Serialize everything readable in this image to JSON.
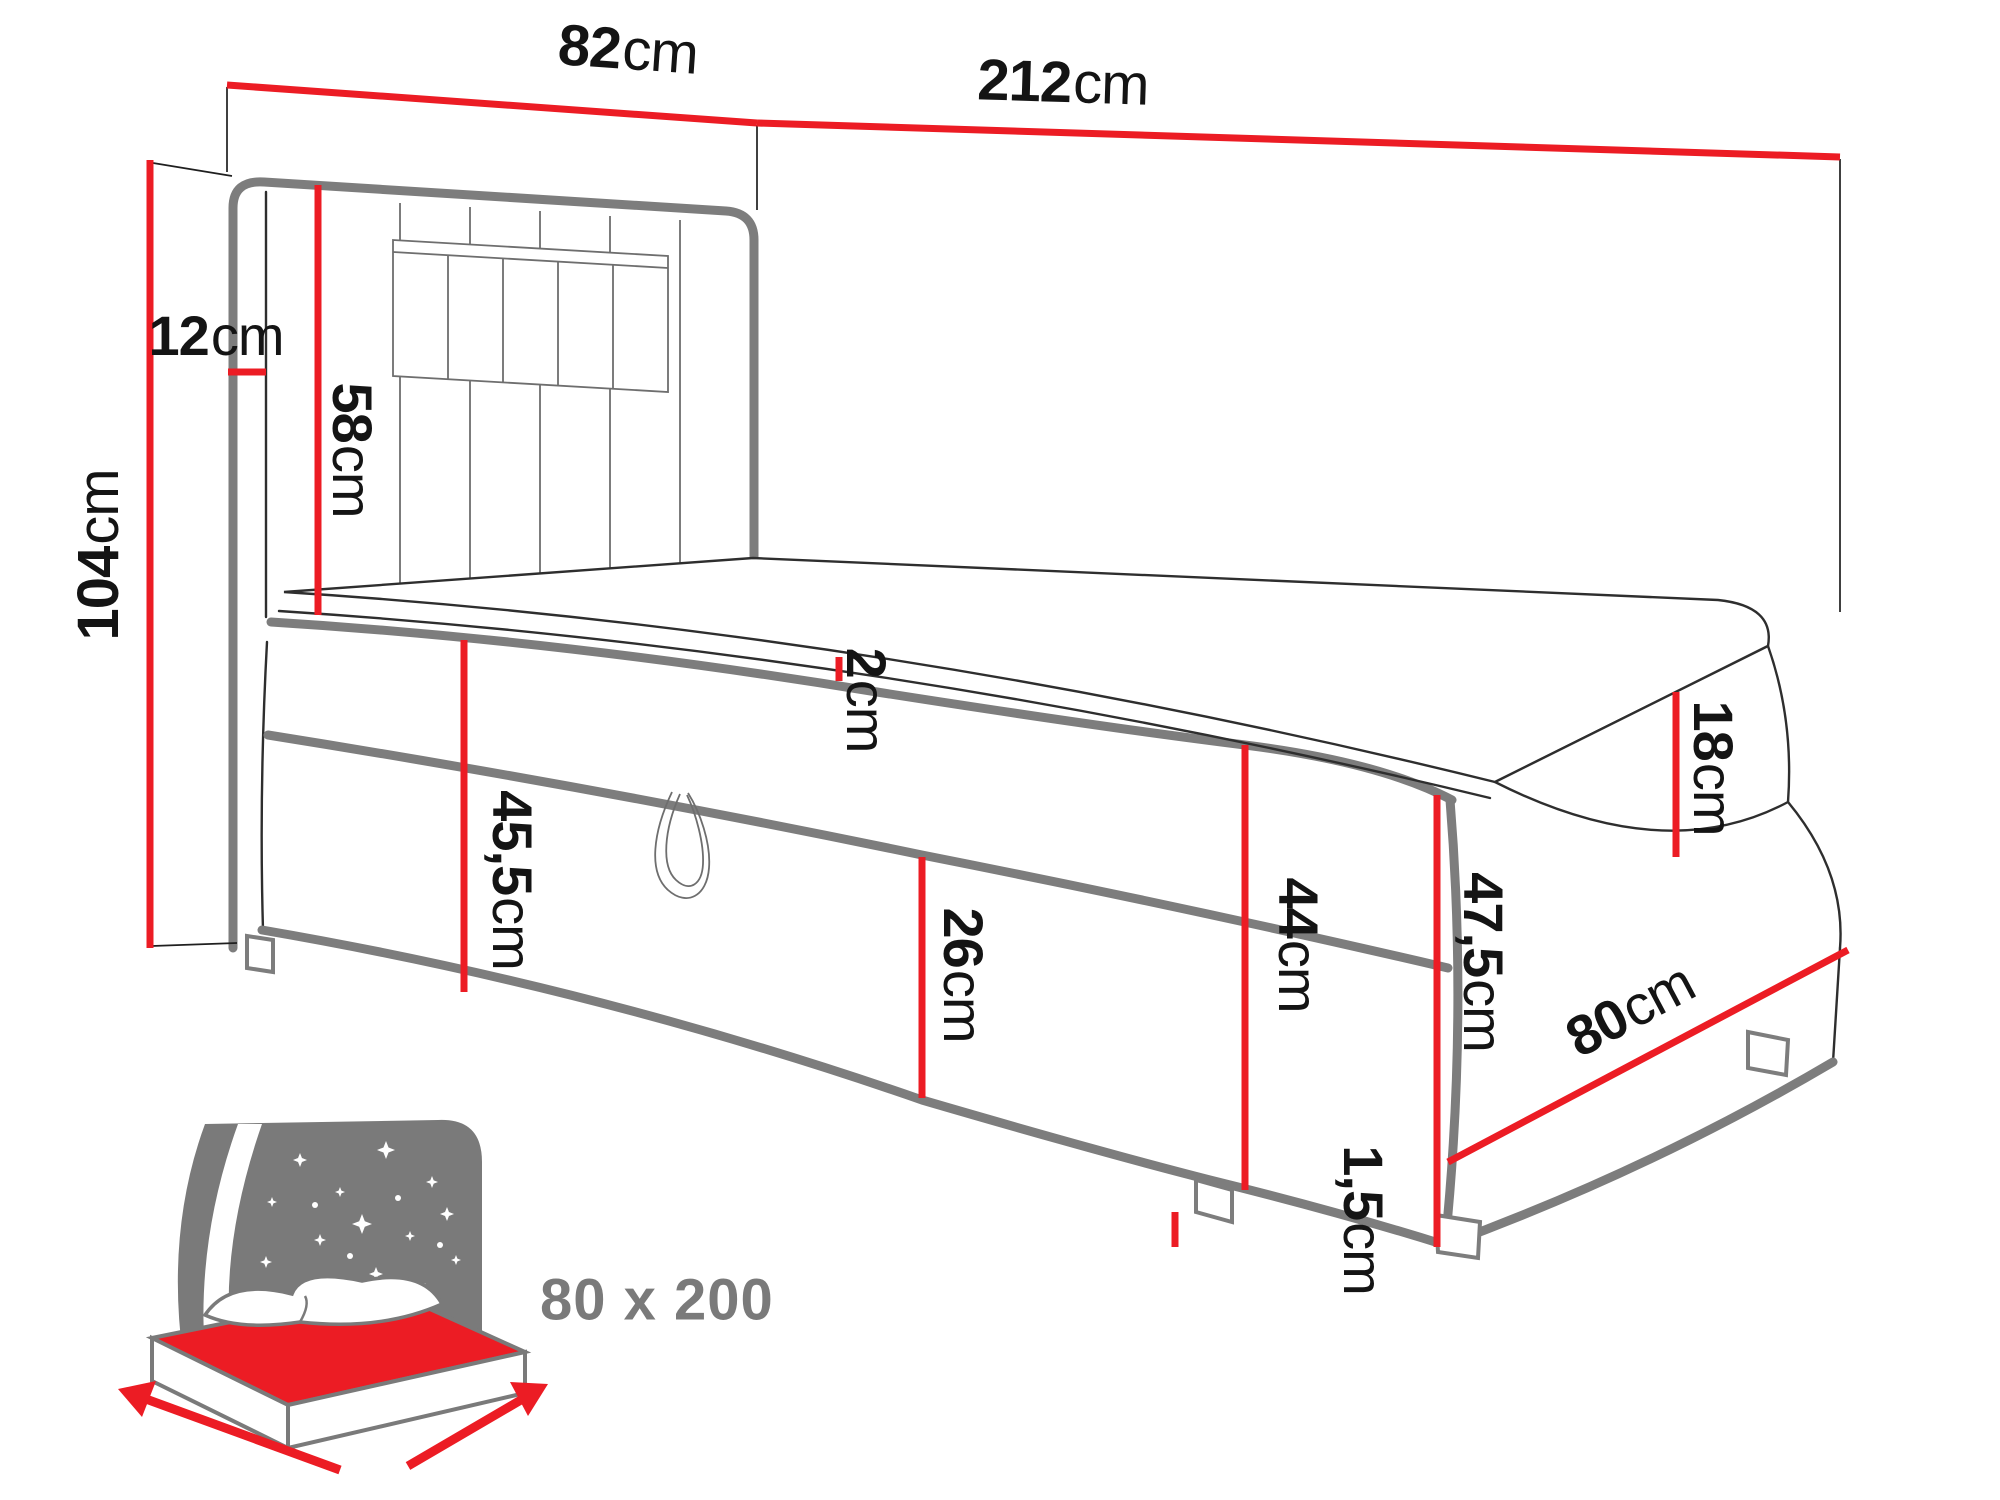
{
  "diagram_type": "bed dimension drawing",
  "dims": {
    "d82": {
      "v": "82",
      "u": "cm"
    },
    "d212": {
      "v": "212",
      "u": "cm"
    },
    "d104": {
      "v": "104",
      "u": "cm"
    },
    "d12": {
      "v": "12",
      "u": "cm"
    },
    "d58": {
      "v": "58",
      "u": "cm"
    },
    "d2": {
      "v": "2",
      "u": "cm"
    },
    "d455": {
      "v": "45,5",
      "u": "cm"
    },
    "d26": {
      "v": "26",
      "u": "cm"
    },
    "d44": {
      "v": "44",
      "u": "cm"
    },
    "d18": {
      "v": "18",
      "u": "cm"
    },
    "d475": {
      "v": "47,5",
      "u": "cm"
    },
    "d15": {
      "v": "1,5",
      "u": "cm"
    },
    "d80": {
      "v": "80",
      "u": "cm"
    }
  },
  "size_badge": "80 x 200",
  "colors": {
    "accent": "#ec1c24",
    "outline": "#7d7d7d",
    "line": "#2e2e2e",
    "icon": "#7a7a7a",
    "label": "#141414"
  }
}
